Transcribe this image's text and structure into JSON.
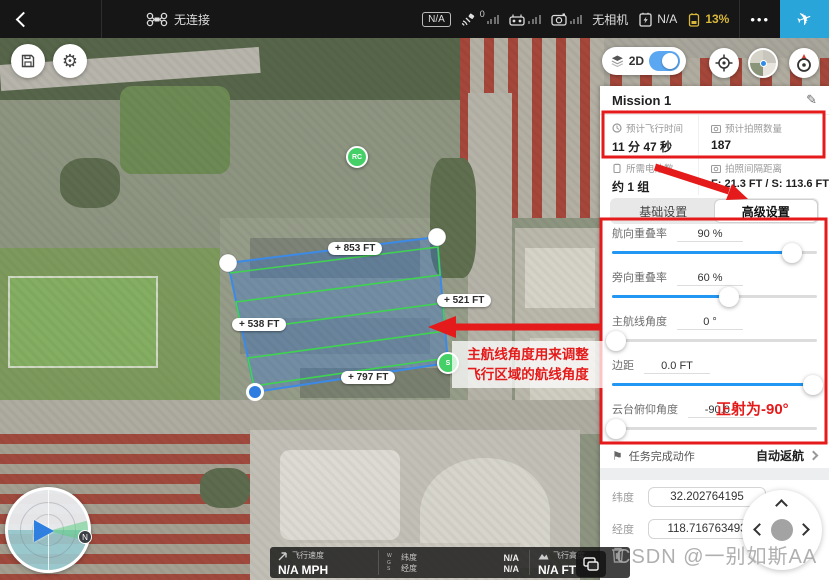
{
  "topbar": {
    "connection_status": "无连接",
    "flight_mode_badge": "N/A",
    "satellite_count": "0",
    "camera_status": "无相机",
    "aircraft_battery": "N/A",
    "rc_battery_percent": "13%",
    "more_label": "•••"
  },
  "map_controls": {
    "mode_label": "2D"
  },
  "map": {
    "edge_labels": {
      "top": "+ 853 FT",
      "right": "+ 521 FT",
      "left": "+ 538 FT",
      "bottom": "+ 797 FT"
    },
    "rc_marker": "RC",
    "start_marker": "S"
  },
  "panel": {
    "title": "Mission 1",
    "stats": [
      {
        "label": "预计飞行时间",
        "value": "11 分 47 秒"
      },
      {
        "label": "预计拍照数量",
        "value": "187"
      },
      {
        "label": "所需电池数",
        "value": "约 1 组"
      },
      {
        "label": "拍照间隔距离",
        "value": "F: 21.3 FT / S: 113.6 FT"
      }
    ],
    "tabs": [
      {
        "label": "基础设置"
      },
      {
        "label": "高级设置"
      }
    ],
    "sliders": [
      {
        "label": "航向重叠率",
        "value": "90 %"
      },
      {
        "label": "旁向重叠率",
        "value": "60 %"
      },
      {
        "label": "主航线角度",
        "value": "0 °"
      },
      {
        "label": "边距",
        "value": "0.0 FT"
      },
      {
        "label": "云台俯仰角度",
        "value": "-90.0 °"
      }
    ],
    "finish_action": {
      "label": "任务完成动作",
      "value": "自动返航"
    },
    "coordinates": {
      "lat_label": "纬度",
      "lat_value": "32.202764195",
      "lng_label": "经度",
      "lng_value": "118.716763493"
    }
  },
  "telemetry": {
    "speed_label": "飞行速度",
    "speed_value": "N/A MPH",
    "wgs_label": "WGS",
    "lat_label": "纬度",
    "lat_value": "N/A",
    "lng_label": "经度",
    "lng_value": "N/A",
    "alt_label": "飞行高度",
    "alt_value": "N/A FT"
  },
  "annotations": {
    "route_angle_note_line1": "主航线角度用来调整",
    "route_angle_note_line2": "飞行区域的航线角度",
    "gimbal_note": "正射为-90°"
  },
  "watermark": "CSDN @一别如斯AA",
  "colors": {
    "accent_blue": "#2196f3",
    "annotation_red": "#e51a1a",
    "takeoff_blue": "#2aa5da",
    "battery_warning": "#d8b83a",
    "route_green": "#3fd44f"
  }
}
